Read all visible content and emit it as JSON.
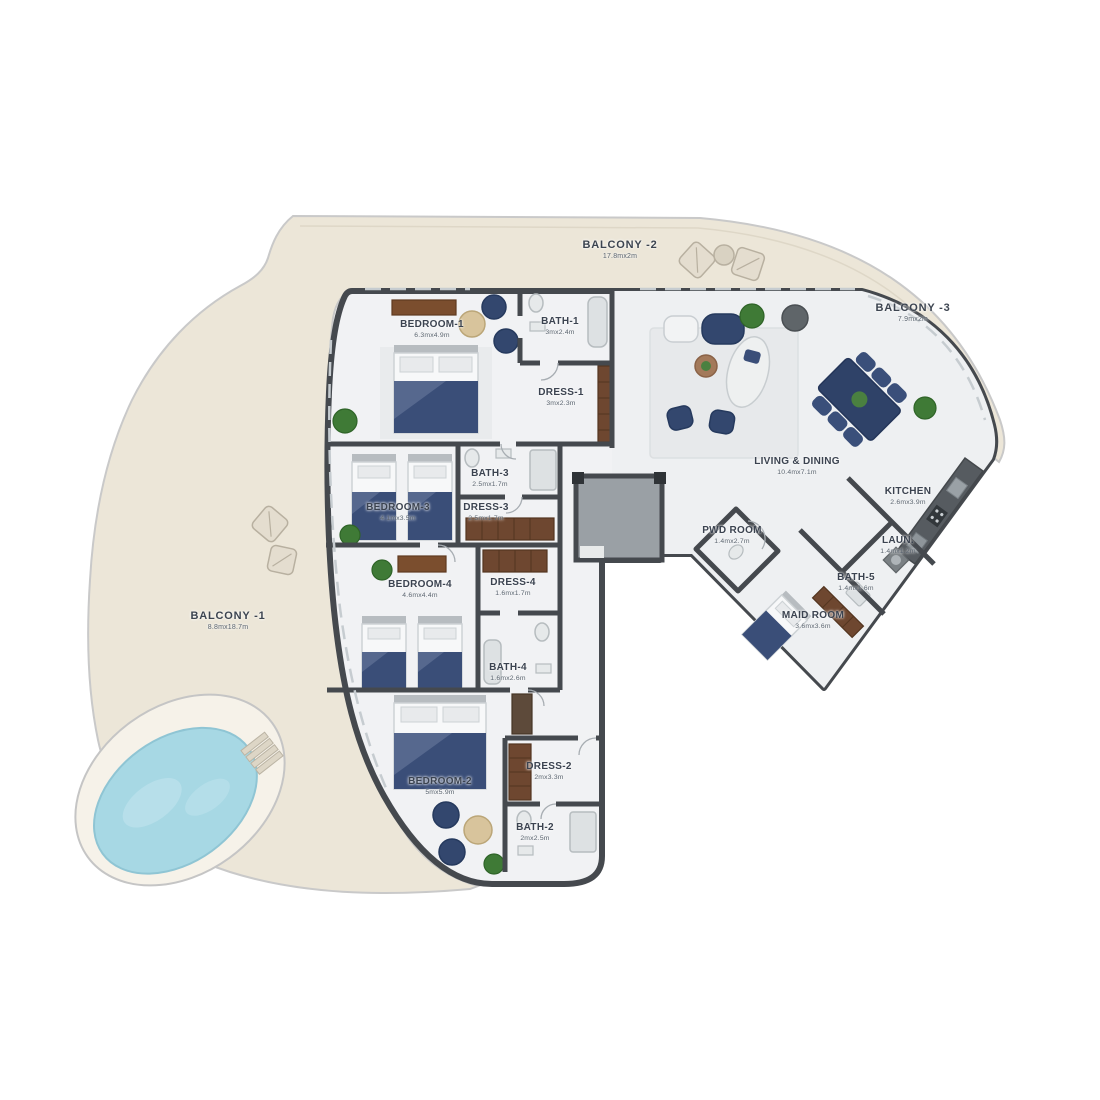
{
  "plan": {
    "title": "apartment-floor-plan",
    "colors": {
      "terrace": "#ece6d8",
      "terrace_line": "#c9c9c9",
      "wall": "#45494e",
      "interior": "#f1f2f4",
      "living_floor": "#eef0f2",
      "pool_water": "#a7d8e4",
      "pool_deck": "#f6f2e9",
      "furniture_navy": "#33476e",
      "wood": "#7b4e2e",
      "plant_green": "#3f7a36",
      "label_text": "#3b4350",
      "dims_text": "#59636e"
    },
    "rooms": [
      {
        "id": "balcony-1",
        "type": "balcony",
        "label": "BALCONY -1",
        "dims": "8.8mx18.7m",
        "x": 228,
        "y": 621
      },
      {
        "id": "balcony-2",
        "type": "balcony",
        "label": "BALCONY -2",
        "dims": "17.8mx2m",
        "x": 620,
        "y": 250
      },
      {
        "id": "balcony-3",
        "type": "balcony",
        "label": "BALCONY -3",
        "dims": "7.9mx2m",
        "x": 913,
        "y": 313
      },
      {
        "id": "bedroom-1",
        "type": "room",
        "label": "BEDROOM-1",
        "dims": "6.3mx4.9m",
        "x": 432,
        "y": 329
      },
      {
        "id": "bath-1",
        "type": "room",
        "label": "BATH-1",
        "dims": "3mx2.4m",
        "x": 560,
        "y": 326
      },
      {
        "id": "dress-1",
        "type": "room",
        "label": "DRESS-1",
        "dims": "3mx2.3m",
        "x": 561,
        "y": 397
      },
      {
        "id": "bath-3",
        "type": "room",
        "label": "BATH-3",
        "dims": "2.5mx1.7m",
        "x": 490,
        "y": 478
      },
      {
        "id": "bedroom-3",
        "type": "room",
        "label": "BEDROOM-3",
        "dims": "4.1mx3.5m",
        "x": 398,
        "y": 512
      },
      {
        "id": "dress-3",
        "type": "room",
        "label": "DRESS-3",
        "dims": "2.5mx1.7m",
        "x": 486,
        "y": 512
      },
      {
        "id": "bedroom-4",
        "type": "room",
        "label": "BEDROOM-4",
        "dims": "4.6mx4.4m",
        "x": 420,
        "y": 589
      },
      {
        "id": "dress-4",
        "type": "room",
        "label": "DRESS-4",
        "dims": "1.6mx1.7m",
        "x": 513,
        "y": 587
      },
      {
        "id": "bath-4",
        "type": "room",
        "label": "BATH-4",
        "dims": "1.6mx2.6m",
        "x": 508,
        "y": 672
      },
      {
        "id": "bedroom-2",
        "type": "room",
        "label": "BEDROOM-2",
        "dims": "5mx5.9m",
        "x": 440,
        "y": 786
      },
      {
        "id": "dress-2",
        "type": "room",
        "label": "DRESS-2",
        "dims": "2mx3.3m",
        "x": 549,
        "y": 771
      },
      {
        "id": "bath-2",
        "type": "room",
        "label": "BATH-2",
        "dims": "2mx2.5m",
        "x": 535,
        "y": 832
      },
      {
        "id": "living-dining",
        "type": "room",
        "label": "LIVING & DINING",
        "dims": "10.4mx7.1m",
        "x": 797,
        "y": 466
      },
      {
        "id": "kitchen",
        "type": "room",
        "label": "KITCHEN",
        "dims": "2.6mx3.9m",
        "x": 908,
        "y": 496
      },
      {
        "id": "pwd-room",
        "type": "room",
        "label": "PWD ROOM",
        "dims": "1.4mx2.7m",
        "x": 732,
        "y": 535
      },
      {
        "id": "laundry",
        "type": "room",
        "label": "LAUN.",
        "dims": "1.4mx1.2m",
        "x": 898,
        "y": 545
      },
      {
        "id": "bath-5",
        "type": "room",
        "label": "BATH-5",
        "dims": "1.4mx1.6m",
        "x": 856,
        "y": 582
      },
      {
        "id": "maid-room",
        "type": "room",
        "label": "MAID ROOM",
        "dims": "3.6mx3.6m",
        "x": 813,
        "y": 620
      }
    ]
  }
}
